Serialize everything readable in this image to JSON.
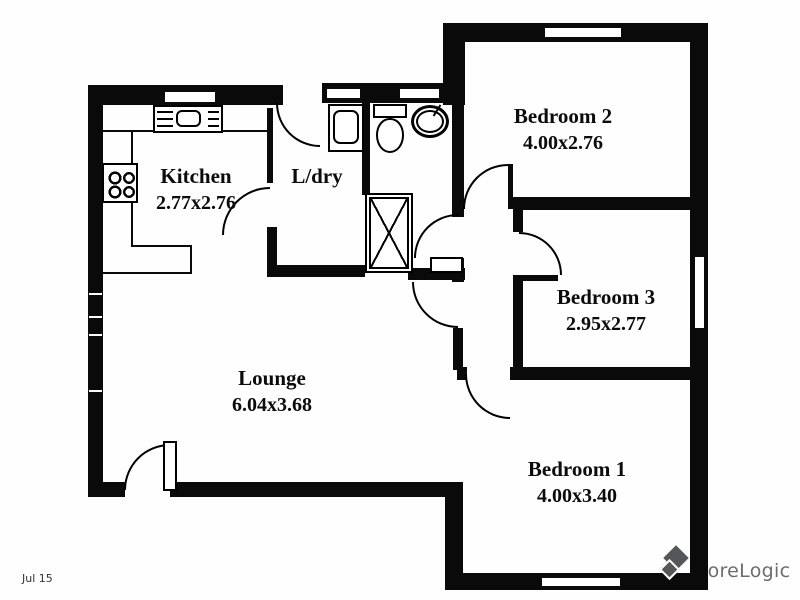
{
  "plan": {
    "background": "#ffffff",
    "wall_color": "#0a0a0a",
    "rooms": [
      {
        "name": "Kitchen",
        "dims": "2.77x2.76",
        "cx": 196,
        "cy": 176
      },
      {
        "name": "L/dry",
        "dims": "",
        "cx": 317,
        "cy": 176
      },
      {
        "name": "Lounge",
        "dims": "6.04x3.68",
        "cx": 272,
        "cy": 378
      },
      {
        "name": "Bedroom 2",
        "dims": "4.00x2.76",
        "cx": 563,
        "cy": 116
      },
      {
        "name": "Bedroom 3",
        "dims": "2.95x2.77",
        "cx": 606,
        "cy": 297
      },
      {
        "name": "Bedroom 1",
        "dims": "4.00x3.40",
        "cx": 577,
        "cy": 469
      }
    ],
    "walls": [
      [
        88,
        85,
        15,
        412
      ],
      [
        88,
        85,
        195,
        20
      ],
      [
        322,
        83,
        121,
        20
      ],
      [
        443,
        23,
        22,
        82
      ],
      [
        443,
        23,
        265,
        19
      ],
      [
        690,
        23,
        18,
        567
      ],
      [
        445,
        573,
        263,
        17
      ],
      [
        88,
        482,
        37,
        15
      ],
      [
        170,
        482,
        293,
        15
      ],
      [
        445,
        482,
        18,
        95
      ],
      [
        452,
        103,
        12,
        114
      ],
      [
        452,
        258,
        12,
        24
      ],
      [
        453,
        328,
        10,
        42
      ],
      [
        457,
        367,
        10,
        13
      ],
      [
        510,
        367,
        198,
        13
      ],
      [
        513,
        197,
        195,
        13
      ],
      [
        513,
        197,
        10,
        35
      ],
      [
        513,
        275,
        10,
        92
      ],
      [
        267,
        108,
        6,
        75
      ],
      [
        267,
        227,
        10,
        45
      ],
      [
        267,
        265,
        98,
        12
      ],
      [
        362,
        103,
        8,
        92
      ],
      [
        408,
        268,
        57,
        12
      ]
    ],
    "counter_lines": [
      [
        103,
        130,
        164,
        2
      ],
      [
        131,
        130,
        2,
        35
      ],
      [
        131,
        200,
        2,
        47
      ],
      [
        131,
        245,
        61,
        2
      ],
      [
        190,
        245,
        2,
        29
      ],
      [
        103,
        272,
        89,
        2
      ]
    ],
    "windows": [
      [
        163,
        90,
        54,
        14
      ],
      [
        325,
        87,
        37,
        13
      ],
      [
        398,
        87,
        43,
        13
      ],
      [
        543,
        26,
        80,
        13
      ],
      [
        693,
        255,
        13,
        75
      ],
      [
        540,
        576,
        82,
        12
      ]
    ],
    "wall_ticks": [
      [
        89,
        293,
        13,
        2
      ],
      [
        89,
        316,
        13,
        2
      ],
      [
        89,
        334,
        13,
        2
      ],
      [
        89,
        390,
        13,
        2
      ]
    ],
    "doors": [
      {
        "x": 124,
        "y": 444,
        "s": 46,
        "dir": "nw",
        "name": "entry-door-arc"
      },
      {
        "x": 222,
        "y": 187,
        "s": 48,
        "dir": "nw",
        "name": "kitchen-door-arc"
      },
      {
        "x": 276,
        "y": 103,
        "s": 44,
        "dir": "sw",
        "name": "laundry-door-arc"
      },
      {
        "x": 414,
        "y": 214,
        "s": 44,
        "dir": "nw",
        "name": "bathroom-door-arc"
      },
      {
        "x": 412,
        "y": 282,
        "s": 46,
        "dir": "sw",
        "name": "hall-door-arc"
      },
      {
        "x": 463,
        "y": 164,
        "s": 45,
        "dir": "nw",
        "name": "bedroom2-door-arc"
      },
      {
        "x": 519,
        "y": 232,
        "s": 43,
        "dir": "ne",
        "name": "bedroom3-door-arc"
      },
      {
        "x": 465,
        "y": 374,
        "s": 45,
        "dir": "sw",
        "name": "bedroom1-door-arc"
      }
    ],
    "door_leaves": [
      [
        508,
        164,
        5,
        45
      ],
      [
        519,
        275,
        39,
        6
      ]
    ],
    "fixtures": [
      {
        "type": "kitchen-sink",
        "name": "kitchen-sink",
        "x": 153,
        "y": 105,
        "w": 70,
        "h": 28
      },
      {
        "type": "cooktop",
        "name": "cooktop",
        "x": 102,
        "y": 163,
        "w": 36,
        "h": 40
      },
      {
        "type": "laundry-tub",
        "name": "laundry-tub",
        "x": 328,
        "y": 104,
        "w": 36,
        "h": 48
      },
      {
        "type": "toilet",
        "name": "toilet",
        "x": 372,
        "y": 104,
        "w": 36,
        "h": 50
      },
      {
        "type": "basin",
        "name": "bathroom-basin",
        "x": 411,
        "y": 105,
        "w": 38,
        "h": 33
      },
      {
        "type": "shower",
        "name": "shower",
        "x": 365,
        "y": 193,
        "w": 48,
        "h": 80
      },
      {
        "type": "cupboard",
        "name": "hall-cupboard",
        "x": 430,
        "y": 257,
        "w": 33,
        "h": 16
      },
      {
        "type": "door-leaf",
        "name": "entry-door-leaf",
        "x": 163,
        "y": 441,
        "w": 14,
        "h": 50
      }
    ]
  },
  "footer": {
    "date": "Jul 15",
    "watermark": "CoreLogic"
  }
}
